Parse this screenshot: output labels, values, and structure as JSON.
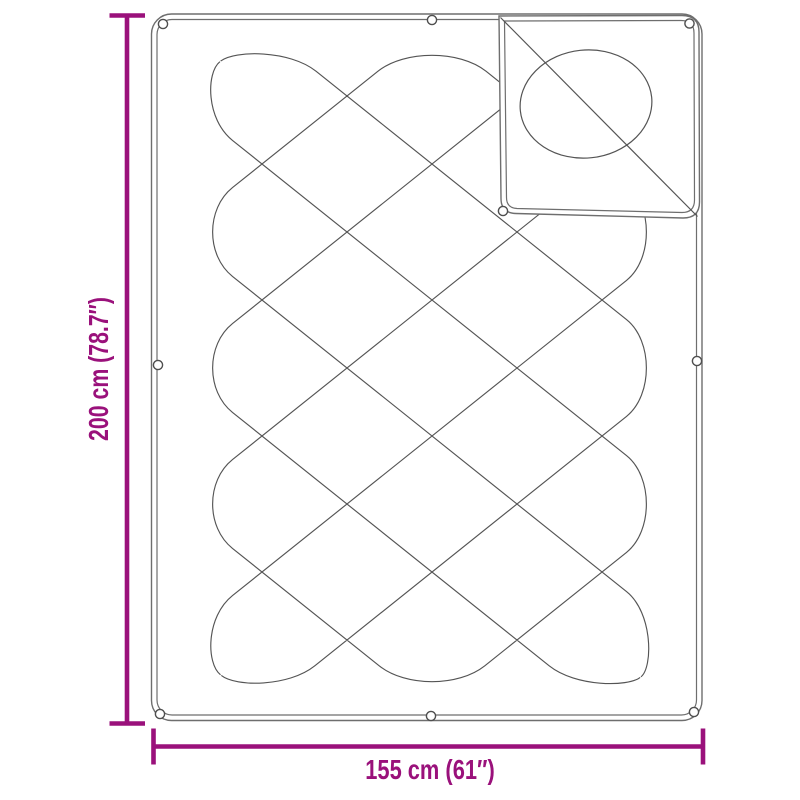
{
  "diagram": {
    "product": "quilted blanket with folded corner",
    "height_label": "200 cm (78.7″)",
    "width_label": "155 cm (61″)"
  },
  "colors": {
    "accent": "#9A117B",
    "quilt_line": "#545454",
    "border_line": "#6E6E6E",
    "eyelet_line": "#4F4F4F",
    "background": "#FFFFFF"
  }
}
